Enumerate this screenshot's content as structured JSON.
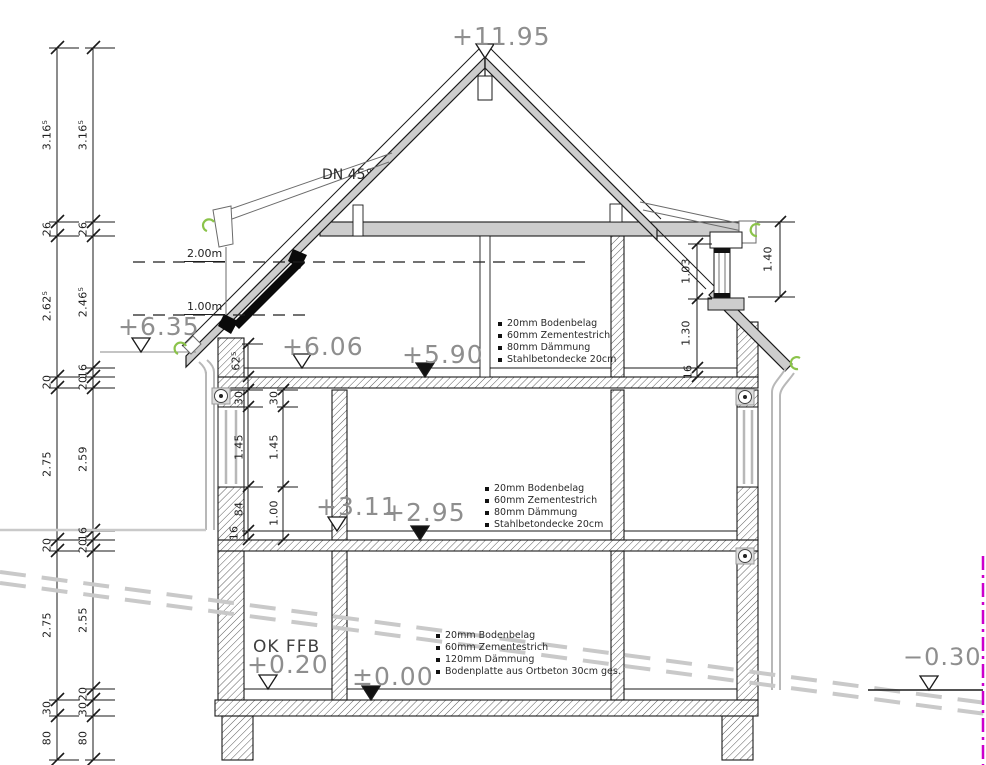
{
  "drawing": {
    "levels": {
      "ridge": "+11.95",
      "eaves_left": "+6.35",
      "dg_ffb": "+6.06",
      "dg_raw": "+5.90",
      "og_ffb": "+3.11",
      "og_raw": "+2.95",
      "eg_ffb_label": "OK FFB",
      "eg_ffb": "+0.20",
      "eg_raw": "±0.00",
      "ground_right": "−0.30"
    },
    "roof": {
      "pitch": "DN 45°"
    },
    "head_heights": {
      "h2": "2.00m",
      "h1": "1.00m"
    },
    "chains": {
      "outer": [
        "3.16⁵",
        "26",
        "2.62⁵",
        "20",
        "2.75",
        "20",
        "2.75",
        "30",
        "80"
      ],
      "inner": [
        "3.16⁵",
        "26",
        "2.46⁵",
        "16",
        "20",
        "2.59",
        "16",
        "20",
        "2.55",
        "20",
        "30",
        "80"
      ],
      "knee": "62⁵",
      "window_left_a": [
        "30",
        "1.45",
        "84",
        "16"
      ],
      "window_left_b": [
        "30",
        "1.45",
        "1.00"
      ],
      "right_chain": [
        "1.03",
        "1.30",
        "16"
      ],
      "right_eave": "1.40"
    },
    "buildups": {
      "dg": [
        "20mm Bodenbelag",
        "60mm Zementestrich",
        "80mm Dämmung",
        "Stahlbetondecke 20cm"
      ],
      "og": [
        "20mm Bodenbelag",
        "60mm Zementestrich",
        "80mm Dämmung",
        "Stahlbetondecke 20cm"
      ],
      "eg": [
        "20mm Bodenbelag",
        "60mm Zementestrich",
        "120mm Dämmung",
        "Bodenplatte aus Ortbeton 30cm ges."
      ]
    },
    "colors": {
      "roof_fill": "#cdcdcd",
      "terrain": "#c9c9c9",
      "gutter": "#8bc34a",
      "boundary": "#cc00cc",
      "elevation_text": "#8e8e8e"
    }
  }
}
